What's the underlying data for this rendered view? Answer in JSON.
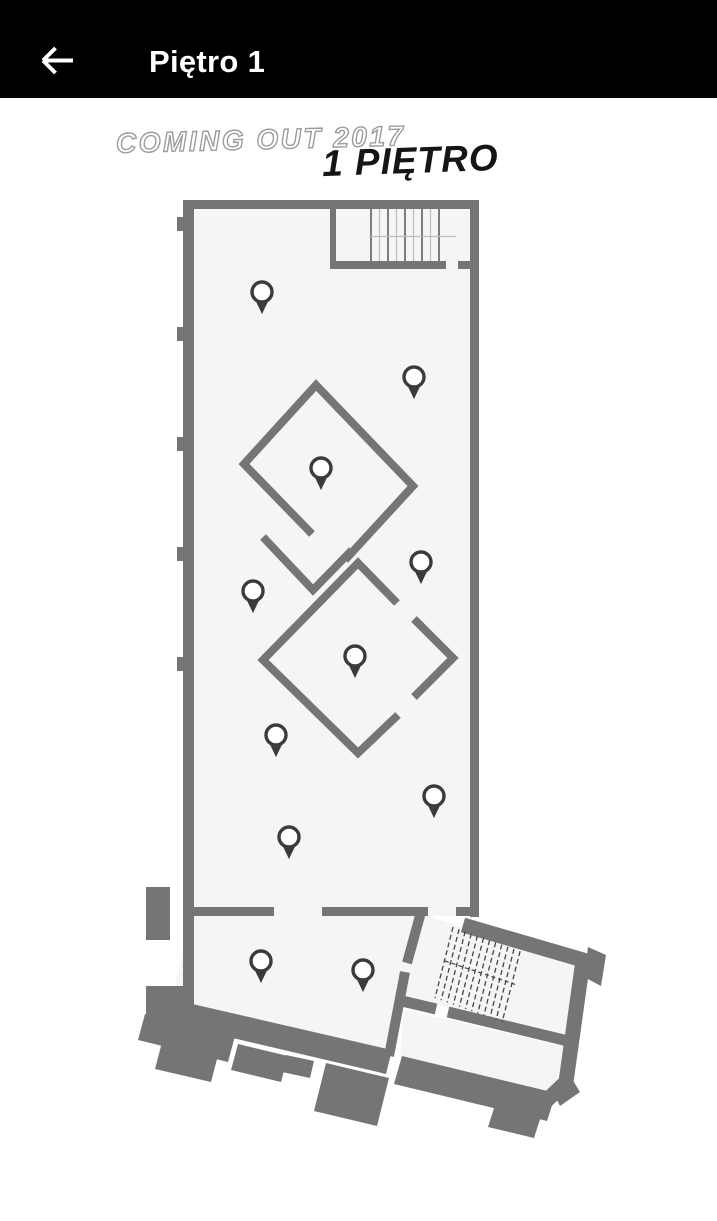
{
  "app_bar": {
    "title": "Piętro 1",
    "back_label": "Back"
  },
  "floor_plan": {
    "watermark": "COMING OUT 2017",
    "floor_label": "1 PIĘTRO",
    "colors": {
      "header_bg": "#000000",
      "header_text": "#ffffff",
      "wall_gray": "#757575",
      "floor_fill": "#f5f5f5",
      "pin_dark": "#3b3b3b",
      "pin_fill": "#ffffff",
      "watermark_outline": "#9c9c9c",
      "floor_label_text": "#151515"
    },
    "pins": [
      {
        "x": 262,
        "y": 293
      },
      {
        "x": 414,
        "y": 378
      },
      {
        "x": 321,
        "y": 469
      },
      {
        "x": 421,
        "y": 563
      },
      {
        "x": 253,
        "y": 592
      },
      {
        "x": 355,
        "y": 657
      },
      {
        "x": 276,
        "y": 736
      },
      {
        "x": 434,
        "y": 797
      },
      {
        "x": 289,
        "y": 838
      },
      {
        "x": 261,
        "y": 962
      },
      {
        "x": 363,
        "y": 971
      }
    ]
  }
}
